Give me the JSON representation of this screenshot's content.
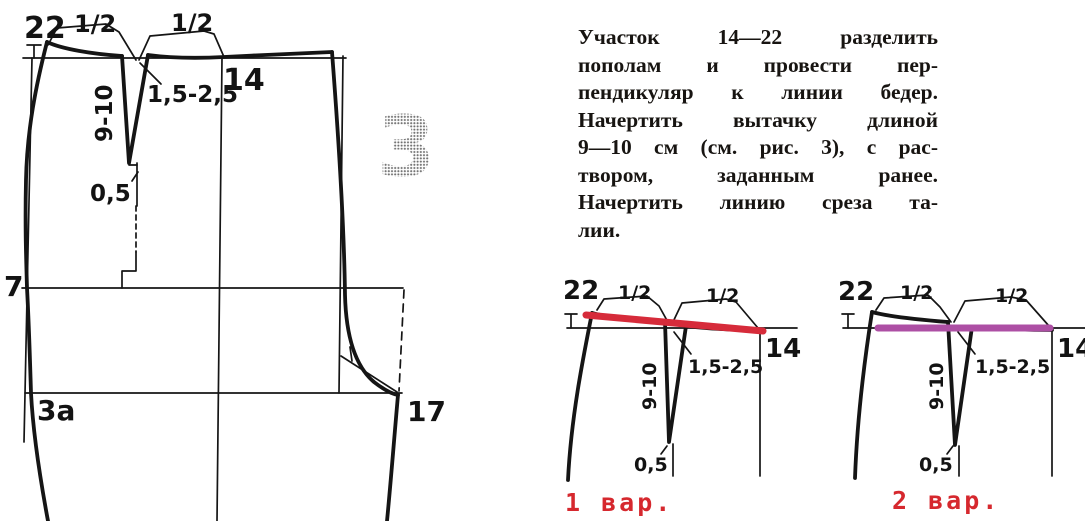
{
  "figure": {
    "number": "3"
  },
  "main_diagram": {
    "point_22": "22",
    "half_left": "1/2",
    "half_right": "1/2",
    "point_14": "14",
    "dart_opening": "1,5-2,5",
    "dart_length": "9-10",
    "offset": "0,5",
    "point_7": "7",
    "point_3a": "3а",
    "point_17": "17"
  },
  "instructions": {
    "lines": [
      "Участок 14—22 разделить",
      "пополам и провести пер-",
      "пендикуляр к линии бедер.",
      "Начертить вытачку длиной",
      "9—10 см (см. рис. 3), с рас-",
      "твором, заданным ранее.",
      "Начертить линию среза та-",
      "лии."
    ]
  },
  "variants": [
    {
      "caption": "1 вар.",
      "line_color": "#d62b3a",
      "point_22": "22",
      "half_left": "1/2",
      "half_right": "1/2",
      "point_14": "14",
      "dart_opening": "1,5-2,5",
      "dart_length": "9-10",
      "offset": "0,5"
    },
    {
      "caption": "2 вар.",
      "line_color": "#ad4fa4",
      "point_22": "22",
      "half_left": "1/2",
      "half_right": "1/2",
      "point_14": "14",
      "dart_opening": "1,5-2,5",
      "dart_length": "9-10",
      "offset": "0,5"
    }
  ],
  "colors": {
    "ink": "#151515",
    "caption": "#d6282e",
    "variant1_line": "#d62b3a",
    "variant2_line": "#ad4fa4",
    "figure_number_gray": "#8a8a8a"
  }
}
